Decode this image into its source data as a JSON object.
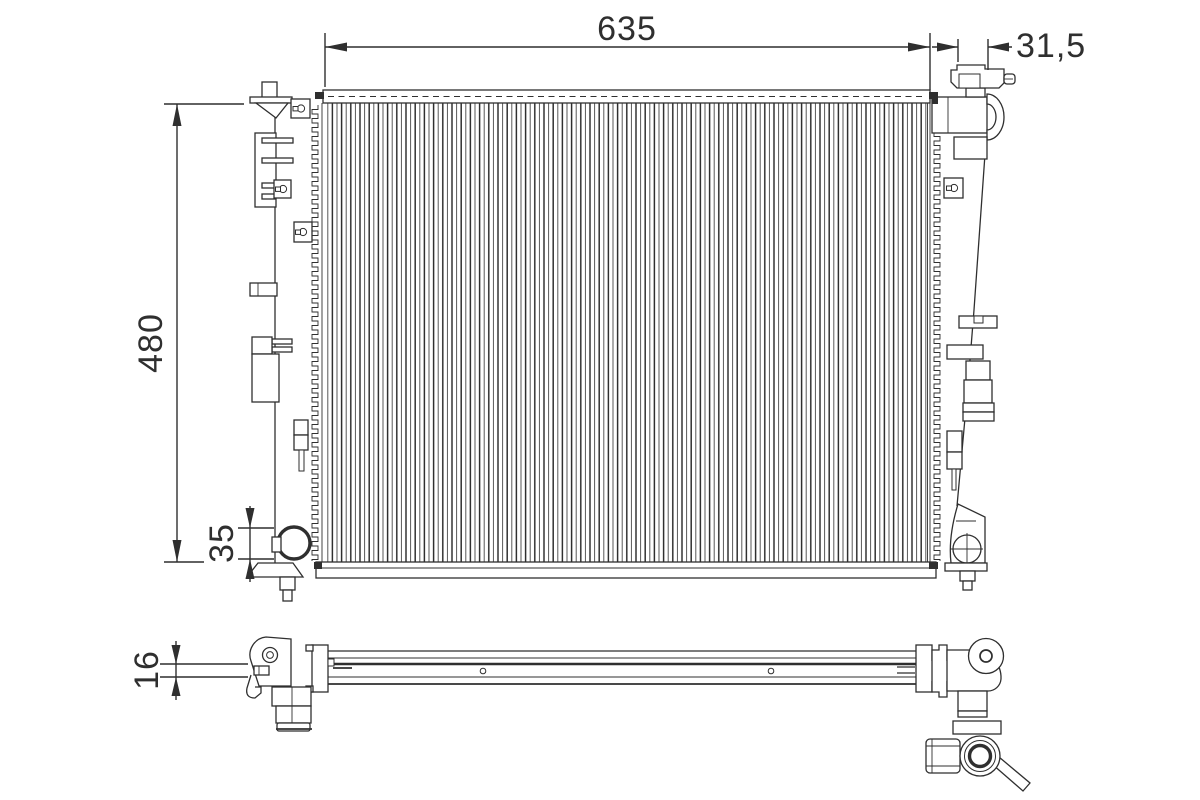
{
  "drawing": {
    "kind": "technical-line-drawing",
    "subject": "engine-cooling-radiator",
    "background_color": "#ffffff",
    "line_color": "#2f2f2f"
  },
  "dimensions": {
    "total_width": {
      "label": "635",
      "orientation": "horizontal"
    },
    "filler_offset": {
      "label": "31,5",
      "orientation": "horizontal"
    },
    "total_height": {
      "label": "480",
      "orientation": "vertical"
    },
    "drain_height": {
      "label": "35",
      "orientation": "vertical"
    },
    "core_thickness": {
      "label": "16",
      "orientation": "vertical"
    }
  }
}
